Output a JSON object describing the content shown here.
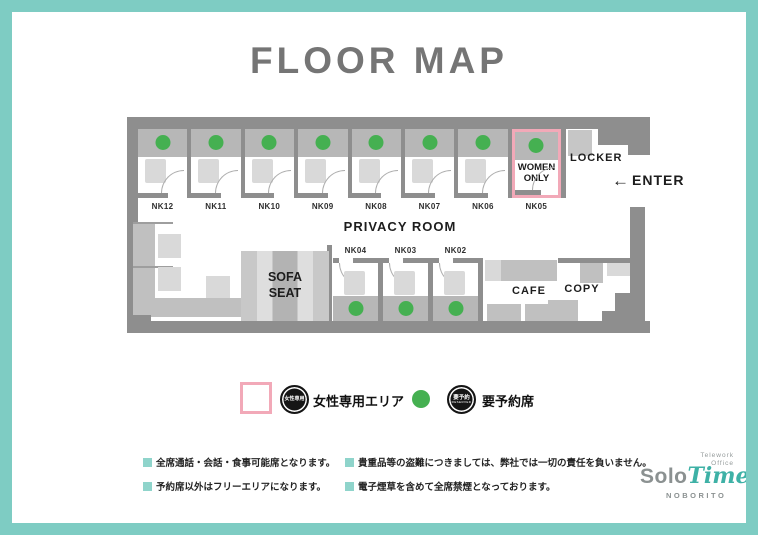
{
  "page": {
    "title": "FLOOR MAP"
  },
  "map": {
    "privacy_room_label": "PRIVACY ROOM",
    "women_only_label": "WOMEN ONLY",
    "sofa_label": "SOFA SEAT",
    "locker_label": "LOCKER",
    "cafe_label": "CAFE",
    "copy_label": "COPY",
    "entrance": {
      "arrow": "←",
      "label": "ENTER"
    },
    "top_booths": [
      {
        "id": "NK12",
        "reserved": true,
        "women_only": false
      },
      {
        "id": "NK11",
        "reserved": true,
        "women_only": false
      },
      {
        "id": "NK10",
        "reserved": true,
        "women_only": false
      },
      {
        "id": "NK09",
        "reserved": true,
        "women_only": false
      },
      {
        "id": "NK08",
        "reserved": true,
        "women_only": false
      },
      {
        "id": "NK07",
        "reserved": true,
        "women_only": false
      },
      {
        "id": "NK06",
        "reserved": true,
        "women_only": false
      },
      {
        "id": "NK05",
        "reserved": true,
        "women_only": true
      }
    ],
    "mid_booths": [
      {
        "id": "NK04",
        "reserved": true
      },
      {
        "id": "NK03",
        "reserved": true
      },
      {
        "id": "NK02",
        "reserved": true
      }
    ]
  },
  "legend": {
    "women_area": {
      "badge_text": "女性専用",
      "label": "女性専用エリア"
    },
    "reserved_seat": {
      "badge_text": "要予約",
      "badge_subtext": "RESERVED",
      "label": "要予約席"
    }
  },
  "notes": [
    "全席通話・会話・食事可能席となります。",
    "予約席以外はフリーエリアになります。",
    "貴重品等の盗難につきましては、弊社では一切の責任を負いません。",
    "電子煙草を含めて全席禁煙となっております。"
  ],
  "logo": {
    "tagline_line1": "Telework",
    "tagline_line2": "Office",
    "brand_first": "Solo",
    "brand_second": "Time",
    "location": "NOBORITO"
  },
  "colors": {
    "frame_teal": "#7ECCC3",
    "reserved_green": "#45B051",
    "women_pink": "#F2A9B8",
    "wall_gray": "#8E8E8E",
    "note_bullet_teal": "#8FD4CB",
    "logo_teal": "#3EB1A6",
    "title_gray": "#757575"
  }
}
